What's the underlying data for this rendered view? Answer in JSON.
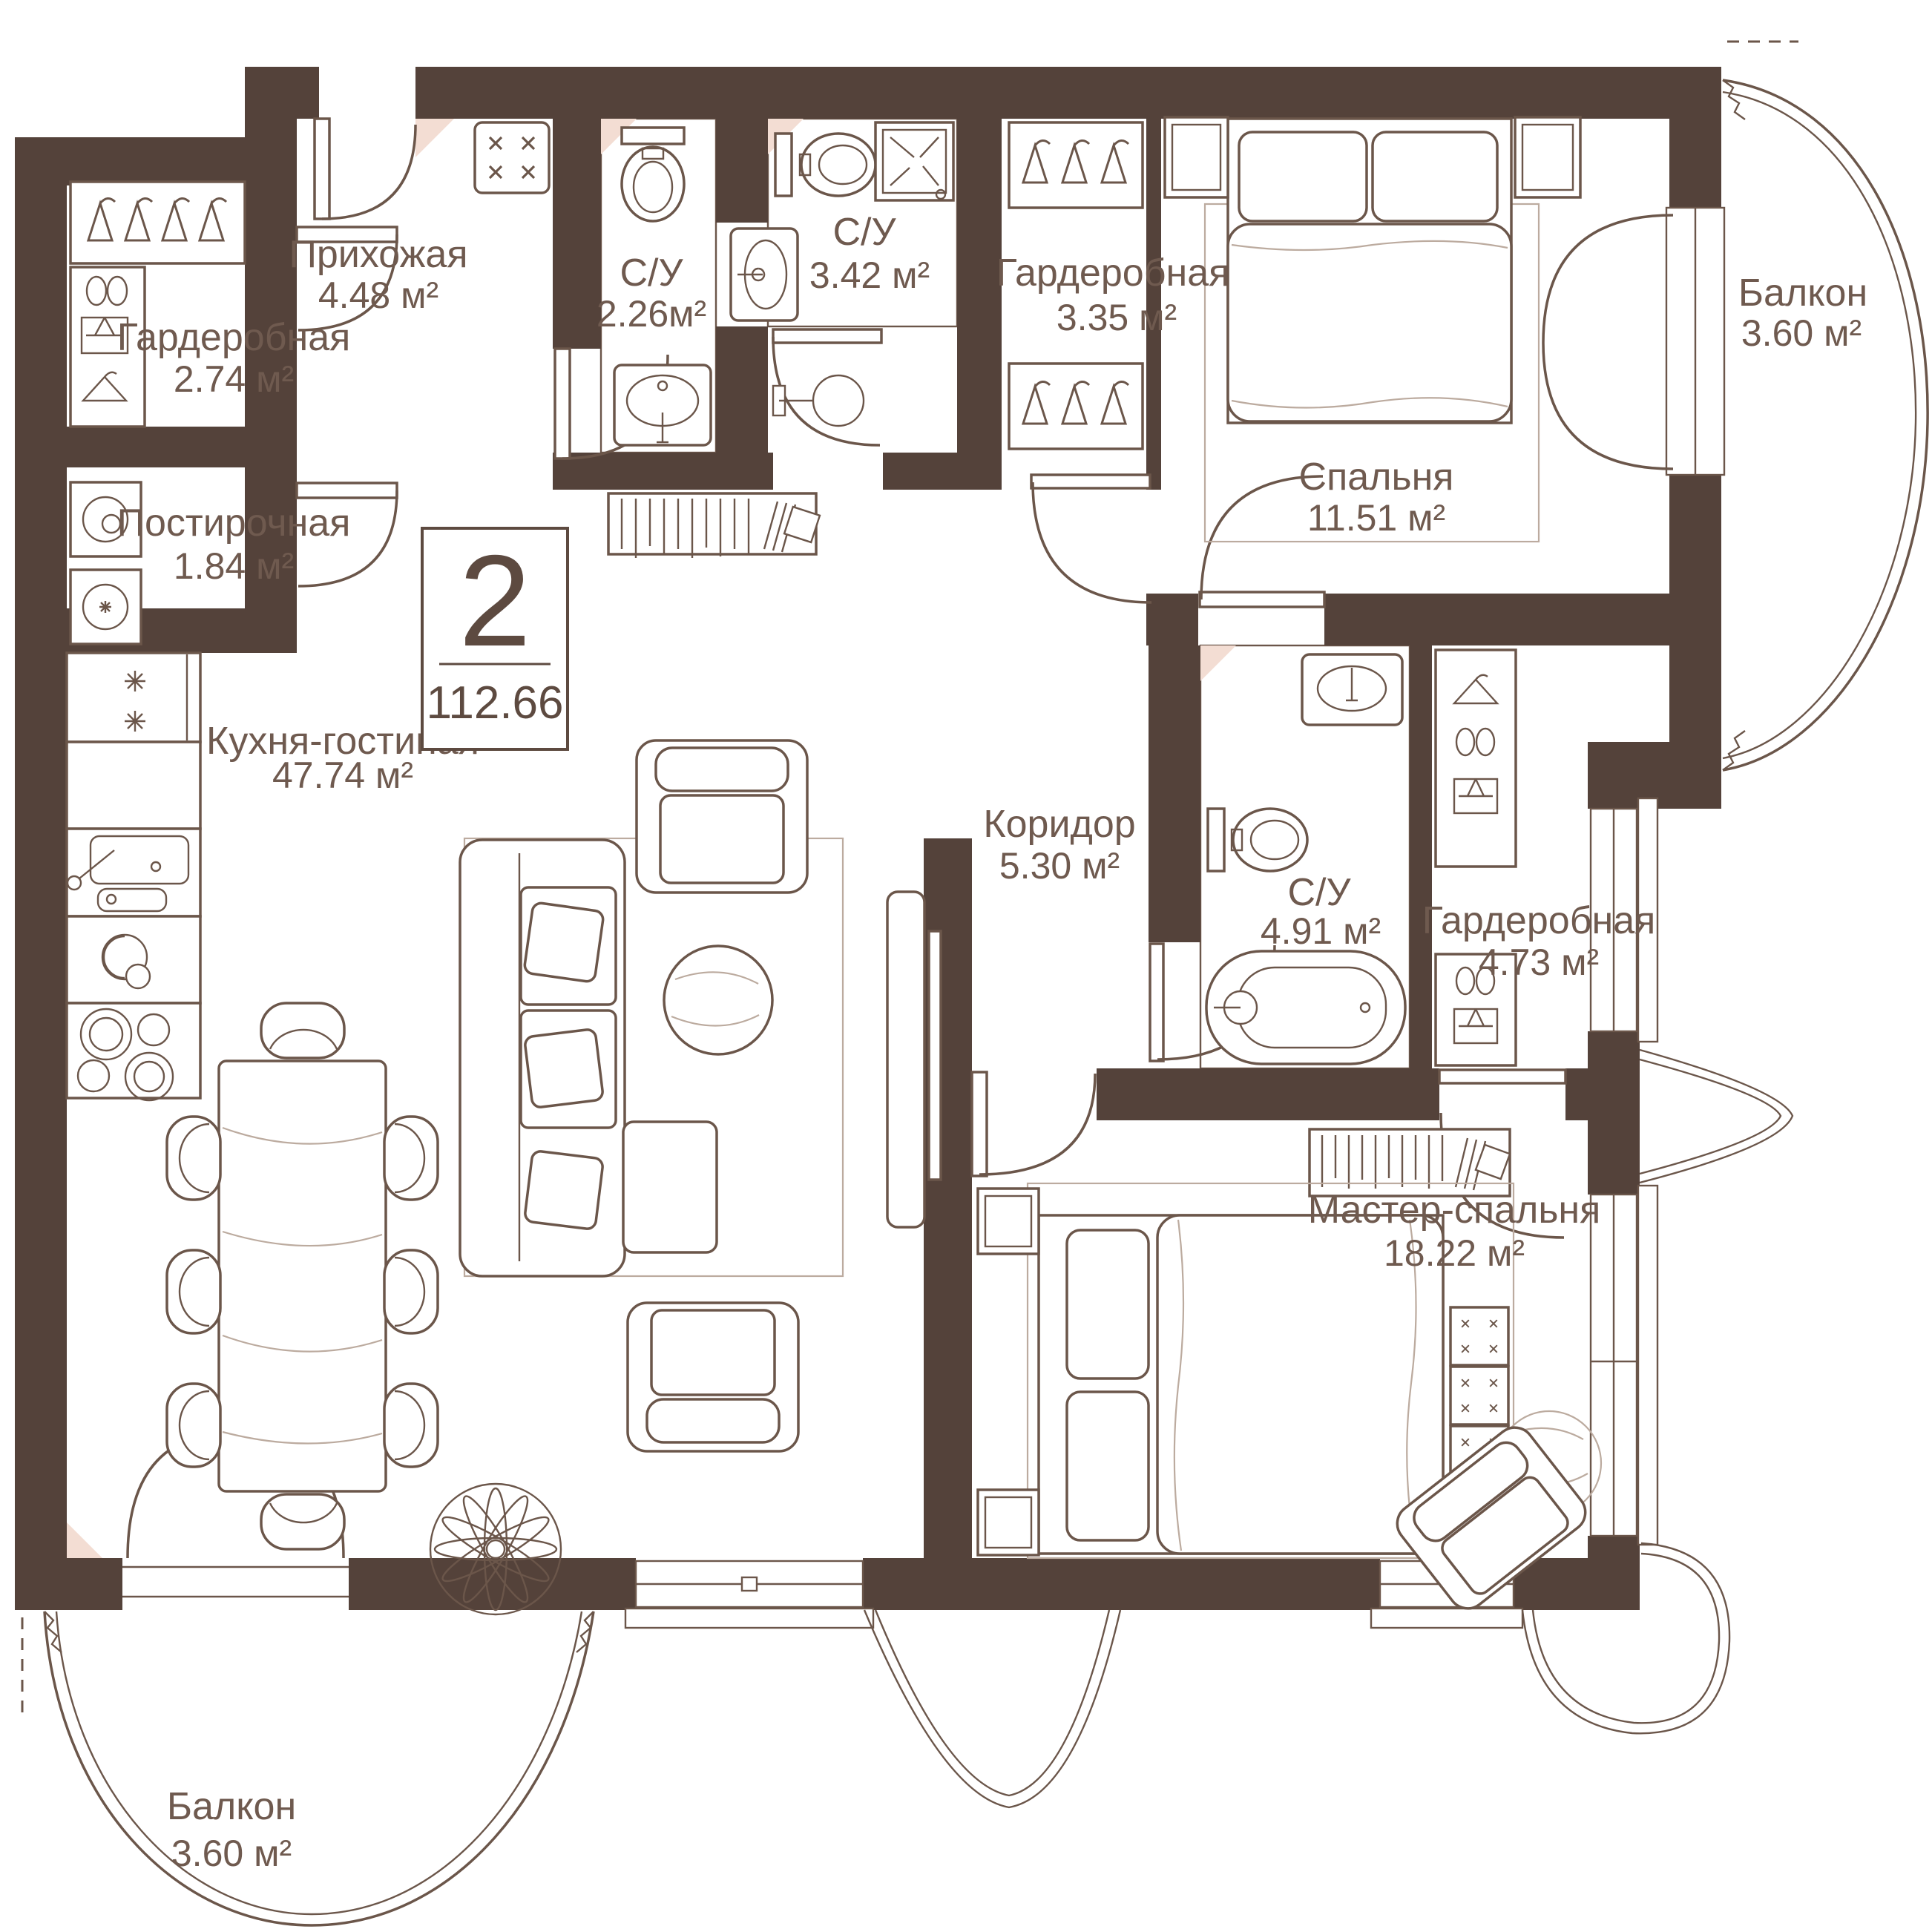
{
  "badge": {
    "rooms_count": "2",
    "total_area": "112.66"
  },
  "rooms": {
    "hallway": {
      "name": "Прихожая",
      "area": "4.48 м²"
    },
    "wardrobe1": {
      "name": "Гардеробная",
      "area": "2.74 м²"
    },
    "laundry": {
      "name": "Постирочная",
      "area": "1.84 м²"
    },
    "bath1": {
      "name": "С/У",
      "area": "2.26м²"
    },
    "bath2": {
      "name": "С/У",
      "area": "3.42 м²"
    },
    "wardrobe2": {
      "name": "Гардеробная",
      "area": "3.35 м²"
    },
    "bedroom": {
      "name": "Спальня",
      "area": "11.51 м²"
    },
    "balcony_right": {
      "name": "Балкон",
      "area": "3.60 м²"
    },
    "kitchen_living": {
      "name": "Кухня-гостиная",
      "area": "47.74 м²"
    },
    "corridor": {
      "name": "Коридор",
      "area": "5.30 м²"
    },
    "bath3": {
      "name": "С/У",
      "area": "4.91 м²"
    },
    "wardrobe3": {
      "name": "Гардеробная",
      "area": "4.73 м²"
    },
    "master_bedroom": {
      "name": "Мастер-спальня",
      "area": "18.22 м²"
    },
    "balcony_bottom": {
      "name": "Балкон",
      "area": "3.60 м²"
    }
  },
  "colors": {
    "wall": "#54423a",
    "line": "#6b564a",
    "tile_line": "#eed6cb",
    "accent": "#f3ddd3",
    "background": "#ffffff"
  }
}
